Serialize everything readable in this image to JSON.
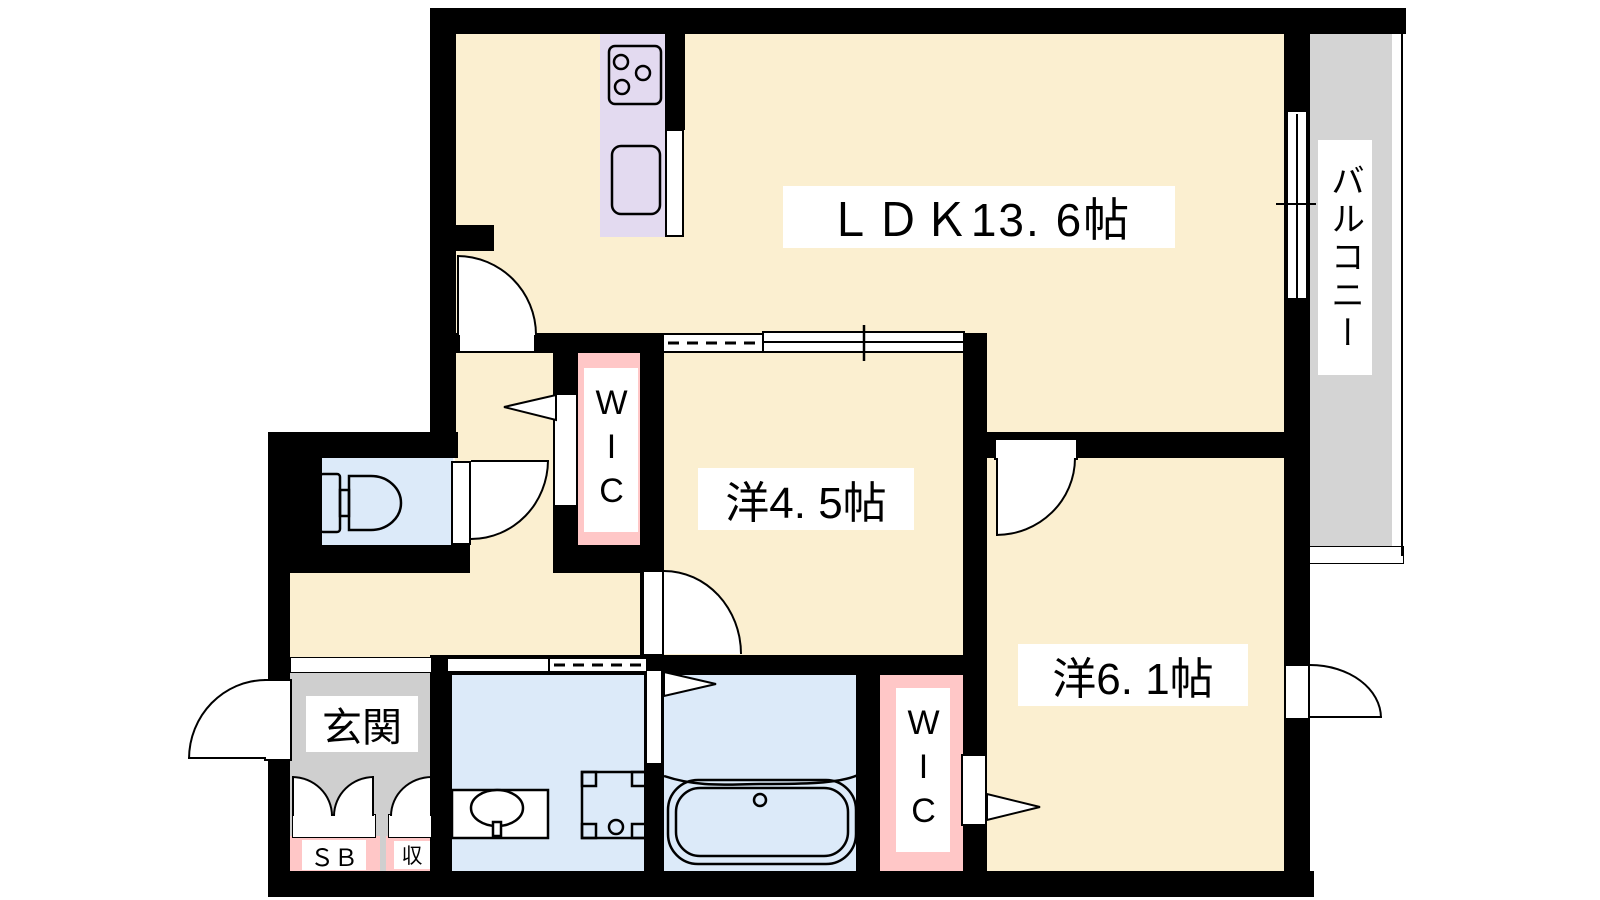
{
  "meta": {
    "type": "apartment-floor-plan"
  },
  "rooms": {
    "ldk": {
      "label": "ＬＤＫ13. 6帖"
    },
    "western_4_5": {
      "label": "洋4. 5帖"
    },
    "western_6_1": {
      "label": "洋6. 1帖"
    },
    "balcony": {
      "label": "バルコニー"
    },
    "wic_upper": {
      "label": "WIC"
    },
    "wic_lower": {
      "label": "WIC"
    },
    "entrance": {
      "label": "玄関"
    },
    "shoe_box": {
      "label": "ＳＢ"
    },
    "storage": {
      "label": "収"
    }
  },
  "fixtures": [
    "toilet-icon",
    "washbasin-icon",
    "washer-pan-icon",
    "bathtub-icon",
    "stove-icon",
    "kitchen-sink-icon"
  ],
  "colors": {
    "wall": "#000000",
    "floor_cream": "#FBEFD0",
    "wet_blue": "#DCEAF9",
    "kitchen_purple": "#E3DAF0",
    "closet_pink": "#FFC7C7",
    "balcony_gray": "#D4D4D4",
    "entrance_gray": "#CFCFCF",
    "label_bg": "#FFFFFF",
    "line": "#000000"
  }
}
